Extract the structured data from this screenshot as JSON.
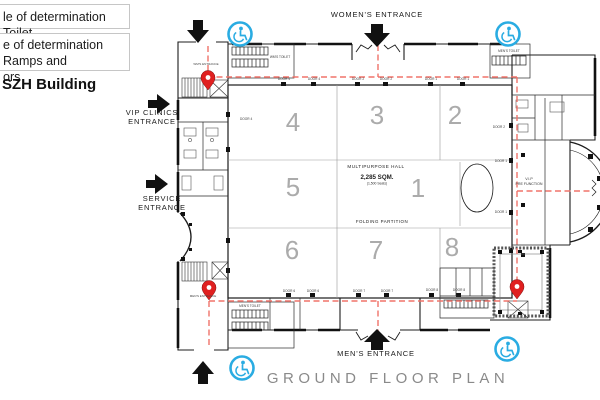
{
  "legend": {
    "item1": "le of determination  Toilet",
    "item2_line1": "e of determination  Ramps and",
    "item2_line2": "ors",
    "building_title": "SZH Building"
  },
  "entrances": {
    "womens": "WOMEN'S  ENTRANCE",
    "mens": "MEN'S  ENTRANCE",
    "vip_line1": "VIP  CLINICS",
    "vip_line2": "ENTRANCE",
    "service_line1": "SERVICE",
    "service_line2": "ENTRANCE"
  },
  "plan": {
    "title": "GROUND  FLOOR  PLAN",
    "hall_name": "MULTIPURPOSE  HALL",
    "hall_area": "2,285 SQM.",
    "hall_seats": "(1,500 Seats)",
    "partition_label": "FOLDING  PARTITION",
    "vip_pre_line1": "V.I.P",
    "vip_pre_line2": "PRE  FUNCTION",
    "rooms": {
      "r1": "1",
      "r2": "2",
      "r3": "3",
      "r4": "4",
      "r5": "5",
      "r6": "6",
      "r7": "7",
      "r8": "8"
    },
    "toilets": {
      "top_left": "WM'S TOILET",
      "top_right": "MEN'S TOILET",
      "bottom_left": "MEN'S TOILET"
    },
    "small_labels": {
      "wm_entrance": "WM'S ENTRANCE",
      "mn_entrance": "MEN'S ENTRANCE"
    },
    "doors": {
      "t1": "DOOR 4",
      "t2": "DOOR 4",
      "t3": "DOOR 2",
      "t4": "DOOR 2",
      "t5": "DOOR 1",
      "t6": "DOOR 1",
      "b1": "DOOR 6",
      "b2": "DOOR 6",
      "b3": "DOOR 7",
      "b4": "DOOR 7",
      "b5": "DOOR 8",
      "b6": "DOOR 8",
      "rv1": "DOOR 2",
      "rv2": "DOOR 1",
      "rv3": "DOOR 1",
      "l1": "DOOR 4"
    }
  },
  "colors": {
    "route_red": "#f0736a",
    "pin_red": "#e02020",
    "access_blue": "#2aace2"
  }
}
